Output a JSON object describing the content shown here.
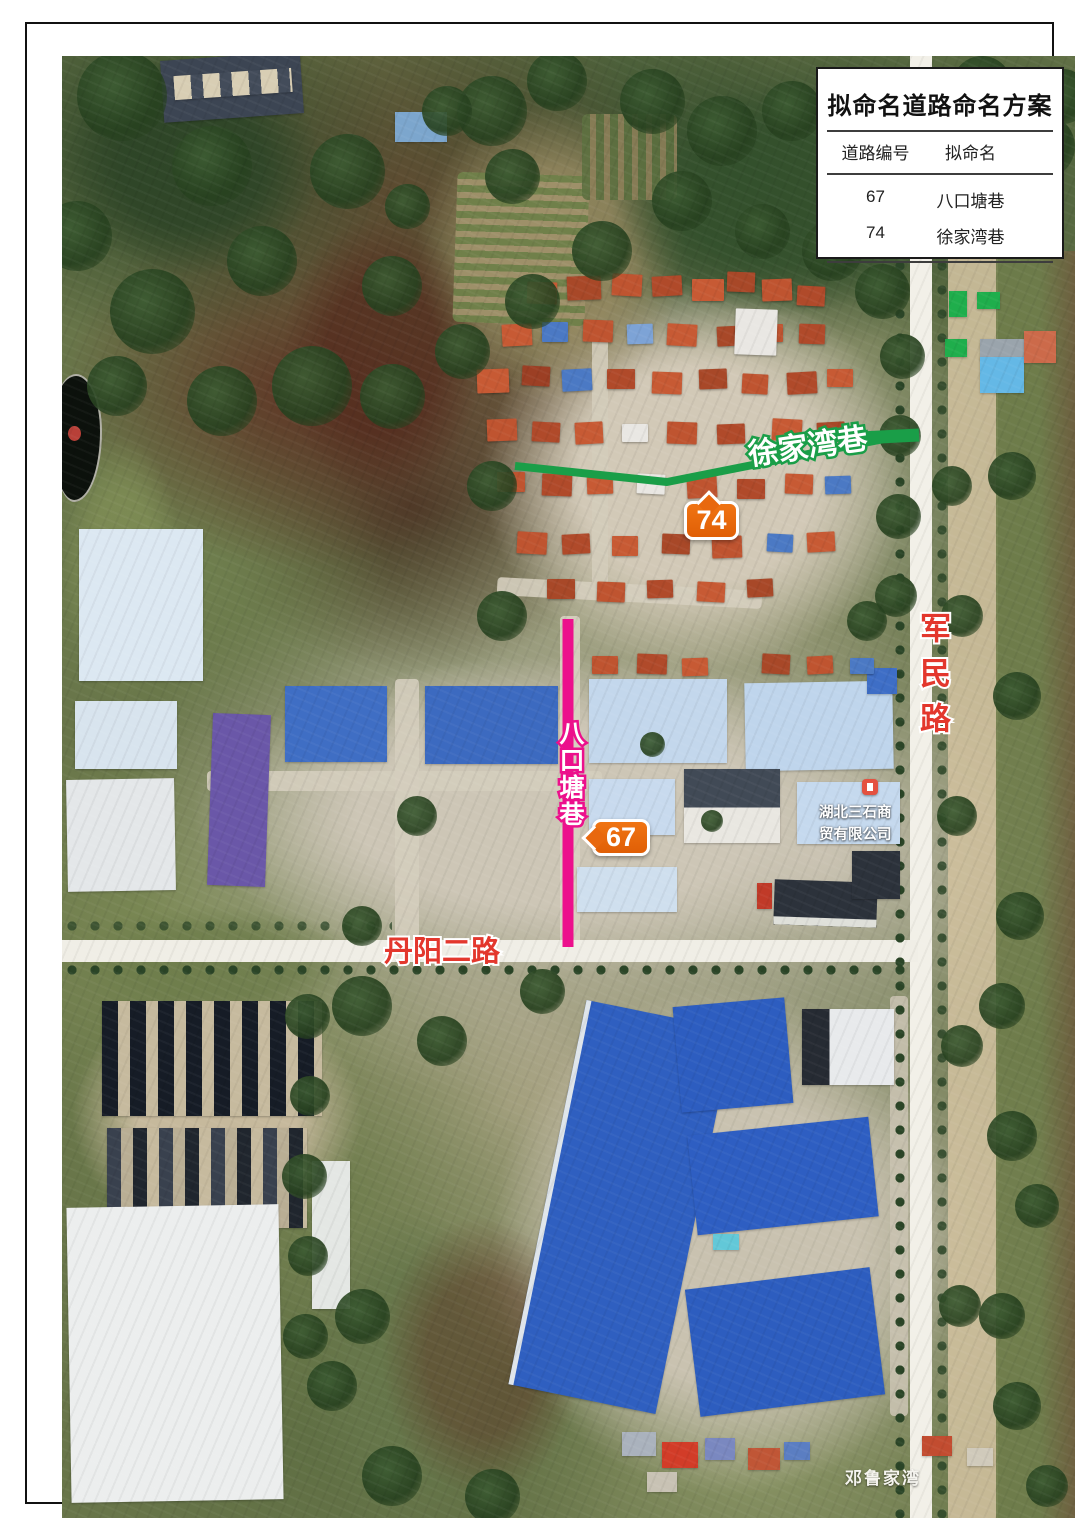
{
  "legend": {
    "title": "拟命名道路命名方案",
    "col_code": "道路编号",
    "col_name": "拟命名",
    "rows": [
      {
        "code": "67",
        "name": "八口塘巷"
      },
      {
        "code": "74",
        "name": "徐家湾巷"
      }
    ]
  },
  "annotations": {
    "green_road_label": "徐家湾巷",
    "green_badge": "74",
    "green_color": "#1a9e48",
    "magenta_road_label": "八口塘巷",
    "magenta_badge": "67",
    "magenta_color": "#ec108c",
    "badge_color": "#e8680e",
    "junmin_road_label": "军民路",
    "danyang_road_label": "丹阳二路",
    "road_label_color": "#e3372d",
    "poi_label": "湖北三石商贸有限公司",
    "village_label": "邓鲁家湾"
  }
}
